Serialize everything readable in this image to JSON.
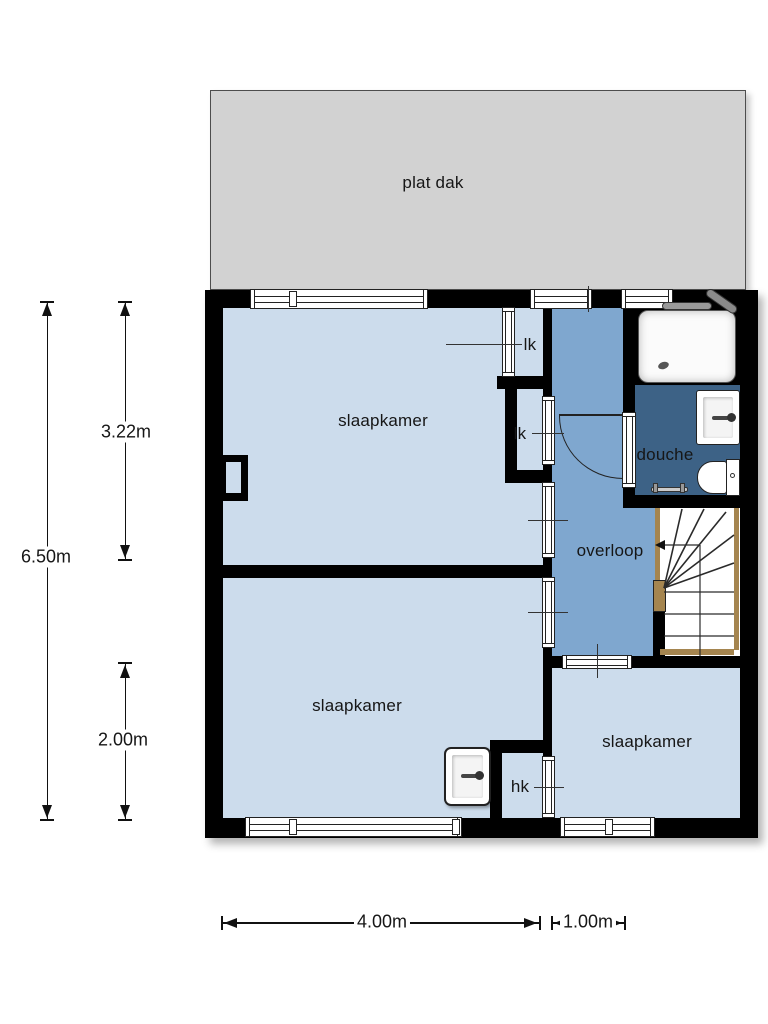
{
  "roof": {
    "label": "plat dak"
  },
  "rooms": {
    "bedroom_top_left": {
      "label": "slaapkamer"
    },
    "bedroom_bottom_left": {
      "label": "slaapkamer"
    },
    "bedroom_bottom_right": {
      "label": "slaapkamer"
    },
    "landing": {
      "label": "overloop"
    },
    "shower_room": {
      "label": "douche"
    },
    "linen_closet_top": {
      "label": "lk"
    },
    "linen_closet_middle": {
      "label": "lk"
    },
    "cupboard": {
      "label": "hk"
    }
  },
  "dimensions": {
    "overall_height": {
      "label": "6.50m"
    },
    "upper_section_height": {
      "label": "3.22m"
    },
    "lower_section_height": {
      "label": "2.00m"
    },
    "main_width": {
      "label": "4.00m"
    },
    "landing_width": {
      "label": "1.00m"
    }
  },
  "colors": {
    "wall": "#000000",
    "bedroom": "#ccdcec",
    "landing": "#7fa7cf",
    "shower": "#3d6286",
    "roof": "#d2d2d2",
    "wood": "#a5854f",
    "line": "#111111"
  }
}
